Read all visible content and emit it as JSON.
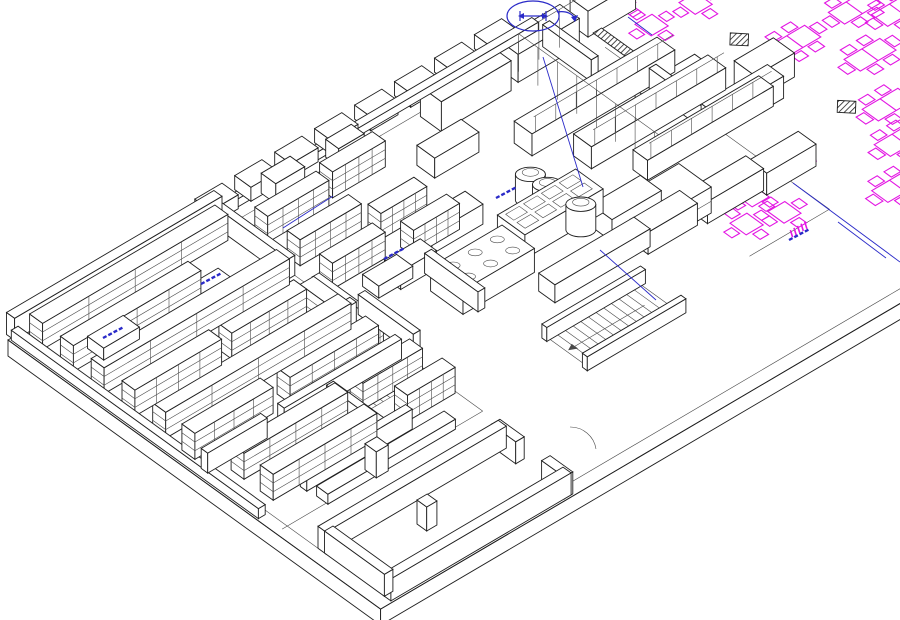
{
  "meta": {
    "view_name": "isometric-cad-floor-plan",
    "description": "Axonometric CAD line drawing of a commercial kitchen, storage rooms and dining area",
    "legible_text_present": false
  },
  "colors": {
    "background": "#ffffff",
    "line": "#1f1f1f",
    "line_light": "#4a4a4a",
    "furniture_magenta": "#e316e3",
    "annotation_blue": "#2a2ac8",
    "white": "#ffffff"
  },
  "projection": {
    "origin": [
      8,
      340
    ],
    "u_axis": [
      0.85,
      -0.5
    ],
    "v_axis": [
      0.81,
      0.585
    ],
    "slab_thickness": 16
  },
  "scene": {
    "slab": {
      "u_max": 1150,
      "v_max": 460,
      "nw_edge_u_end": 620,
      "inset": 14
    },
    "floor_lines": [
      [
        [
          14,
          14
        ],
        [
          14,
          446
        ],
        [
          1150,
          446
        ]
      ],
      [
        [
          14,
          14
        ],
        [
          620,
          14
        ]
      ],
      [
        [
          650,
          55
        ],
        [
          650,
          332
        ],
        [
          556,
          332
        ]
      ],
      [
        [
          8,
          330
        ],
        [
          244,
          330
        ]
      ],
      [
        [
          244,
          14
        ],
        [
          244,
          330
        ]
      ]
    ],
    "walls": [
      [
        4,
        -6,
        244,
        10,
        22
      ],
      [
        2,
        2,
        8,
        305,
        10
      ],
      [
        10,
        228,
        70,
        8,
        20
      ],
      [
        100,
        228,
        138,
        8,
        20
      ],
      [
        236,
        6,
        8,
        92,
        20
      ],
      [
        236,
        128,
        8,
        104,
        20
      ],
      [
        148,
        238,
        8,
        64,
        20
      ],
      [
        58,
        300,
        124,
        8,
        20
      ],
      [
        150,
        168,
        92,
        8,
        20
      ],
      [
        250,
        170,
        8,
        68,
        20
      ],
      [
        330,
        168,
        8,
        66,
        20
      ],
      [
        232,
        -6,
        390,
        8,
        8
      ],
      [
        14,
        368,
        212,
        10,
        22
      ],
      [
        14,
        448,
        212,
        10,
        22
      ],
      [
        14,
        376,
        10,
        74,
        22
      ],
      [
        218,
        368,
        10,
        30,
        22
      ],
      [
        218,
        430,
        10,
        28,
        22
      ],
      [
        610,
        20,
        8,
        60,
        22
      ],
      [
        640,
        120,
        8,
        70,
        22
      ]
    ],
    "step_blocks": {
      "start_u": 235,
      "v": -16,
      "count": 8,
      "spacing": 47,
      "du": 32,
      "dv": 20,
      "h": 14
    },
    "racks": [
      [
        14,
        12,
        218,
        16,
        26
      ],
      [
        14,
        50,
        150,
        16,
        26
      ],
      [
        14,
        88,
        218,
        16,
        26
      ],
      [
        14,
        126,
        102,
        16,
        26
      ],
      [
        128,
        126,
        88,
        16,
        26
      ],
      [
        14,
        164,
        218,
        16,
        26
      ],
      [
        14,
        200,
        92,
        16,
        26
      ],
      [
        126,
        200,
        104,
        16,
        26
      ],
      [
        216,
        134,
        16,
        86,
        26
      ],
      [
        28,
        246,
        122,
        16,
        26
      ],
      [
        28,
        282,
        122,
        16,
        26
      ],
      [
        168,
        246,
        70,
        16,
        26
      ],
      [
        186,
        282,
        56,
        16,
        26
      ],
      [
        256,
        36,
        72,
        16,
        26
      ],
      [
        256,
        76,
        72,
        16,
        26
      ],
      [
        338,
        30,
        62,
        16,
        26
      ],
      [
        256,
        116,
        62,
        16,
        26
      ],
      [
        332,
        96,
        54,
        16,
        26
      ],
      [
        338,
        130,
        54,
        16,
        26
      ]
    ],
    "low_tables": [
      [
        44,
        52,
        42,
        20,
        12
      ],
      [
        148,
        60,
        42,
        20,
        12
      ],
      [
        278,
        146,
        40,
        20,
        12
      ],
      [
        60,
        318,
        150,
        14,
        10
      ]
    ],
    "equipment": [
      {
        "b": [
          318,
          188,
          84,
          40,
          24
        ],
        "top": "burners"
      },
      {
        "b": [
          408,
          176,
          92,
          34,
          24
        ],
        "top": "grid"
      },
      {
        "b": [
          388,
          248,
          112,
          20,
          18
        ]
      },
      {
        "b": [
          468,
          18,
          82,
          26,
          30
        ]
      },
      {
        "b": [
          562,
          16,
          72,
          24,
          28
        ]
      },
      {
        "b": [
          648,
          14,
          56,
          22,
          26
        ]
      },
      {
        "b": [
          352,
          132,
          60,
          22,
          20
        ]
      },
      {
        "b": [
          422,
          62,
          52,
          22,
          20
        ]
      },
      {
        "b": [
          300,
          150,
          42,
          20,
          18
        ]
      },
      {
        "b": [
          296,
          2,
          34,
          18,
          20
        ]
      },
      {
        "b": [
          370,
          4,
          30,
          16,
          18
        ]
      },
      {
        "b": [
          505,
          95,
          168,
          22,
          22
        ],
        "rail": true
      },
      {
        "b": [
          532,
          140,
          158,
          22,
          22
        ],
        "rail": true
      },
      {
        "b": [
          558,
          186,
          148,
          18,
          20
        ],
        "rail": true
      },
      {
        "b": [
          480,
          216,
          58,
          26,
          22
        ]
      },
      {
        "b": [
          492,
          252,
          58,
          22,
          22
        ]
      },
      {
        "b": [
          558,
          256,
          66,
          22,
          22
        ]
      },
      {
        "b": [
          622,
          262,
          58,
          22,
          22
        ]
      },
      {
        "b": [
          612,
          132,
          70,
          22,
          22
        ]
      },
      {
        "b": [
          642,
          182,
          78,
          20,
          22
        ]
      },
      {
        "b": [
          700,
          162,
          46,
          26,
          24
        ]
      },
      {
        "b": [
          520,
          230,
          50,
          40,
          26
        ],
        "top": "panel"
      },
      {
        "b": [
          100,
          400,
          12,
          12,
          24
        ]
      },
      {
        "b": [
          115,
          320,
          14,
          14,
          26
        ]
      }
    ],
    "kettles": [
      [
        464,
        158,
        13,
        26
      ],
      [
        466,
        177,
        13,
        26
      ],
      [
        468,
        196,
        13,
        26
      ],
      [
        470,
        214,
        13,
        26
      ]
    ],
    "free_rails": [
      {
        "dir": "v",
        "u": 572,
        "v0": 30,
        "v1": 220
      },
      {
        "dir": "u",
        "v": 30,
        "u0": 500,
        "u1": 640
      }
    ],
    "stairs": [
      {
        "u": 352,
        "v": 300,
        "du": 108,
        "dv": 40,
        "tread": 9
      },
      {
        "u": 156,
        "v": 240,
        "du": 58,
        "dv": 26,
        "tread": 8
      }
    ],
    "stair_walls": [
      [
        348,
        294,
        116,
        6,
        14
      ],
      [
        348,
        344,
        116,
        6,
        14
      ]
    ],
    "tables_4seat": [
      [
        700,
        60
      ],
      [
        748,
        64
      ],
      [
        612,
        277
      ],
      [
        618,
        310
      ],
      [
        583,
        300
      ],
      [
        700,
        20
      ],
      [
        758,
        16
      ]
    ],
    "tables_6seat": [
      [
        778,
        155
      ],
      [
        847,
        156
      ],
      [
        873,
        182
      ],
      [
        815,
        209
      ],
      [
        782,
        266
      ],
      [
        758,
        306
      ],
      [
        715,
        348
      ],
      [
        910,
        100
      ]
    ],
    "columns_hatched": [
      [
        744,
        122
      ],
      [
        753,
        245
      ]
    ],
    "hatch_bands": [
      [
        585,
        10,
        50,
        12
      ],
      [
        655,
        35,
        10,
        45
      ]
    ],
    "magenta_strips": [
      [
        635,
        100,
        7
      ],
      [
        663,
        276,
        6
      ],
      [
        601,
        334,
        5
      ],
      [
        697,
        20,
        9
      ]
    ],
    "magenta_fixture": [
      200,
      218
    ],
    "blue_lines_screen": [
      [
        [
          543,
          57
        ],
        [
          583,
          187
        ]
      ],
      [
        [
          283,
          228
        ],
        [
          333,
          196
        ]
      ],
      [
        [
          793,
          183
        ],
        [
          900,
          262
        ]
      ],
      [
        [
          838,
          222
        ],
        [
          886,
          258
        ]
      ],
      [
        [
          600,
          250
        ],
        [
          656,
          300
        ]
      ],
      [
        [
          628,
          17
        ],
        [
          652,
          35
        ]
      ]
    ],
    "blue_labels_screen": [
      [
        103,
        338
      ],
      [
        201,
        284
      ],
      [
        384,
        259
      ],
      [
        496,
        198
      ],
      [
        789,
        240
      ]
    ],
    "door_arcs_screen": [
      [
        570,
        427,
        596,
        449,
        26,
        26
      ]
    ],
    "rotation_symbol": {
      "x": 533,
      "y": 16,
      "rx": 26,
      "ry": 15
    }
  }
}
